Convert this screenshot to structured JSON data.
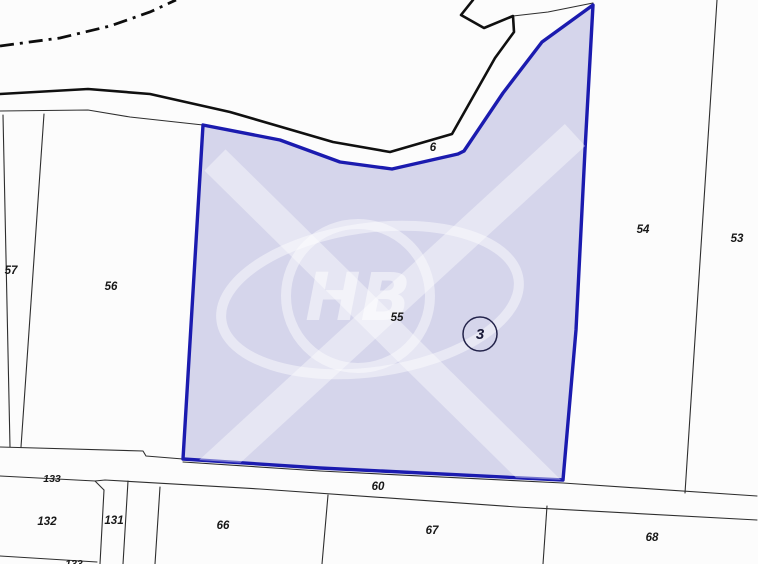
{
  "map": {
    "background_color": "#fcfcfc",
    "selected_parcel": {
      "number": "55",
      "fill": "#d5d5eb",
      "stroke": "#1b1baf",
      "points": "203,125 280,140 340,162 392,169 458,154 464,151 503,93 542,42 593,5 585,150 576,330 563,480 320,468 183,459"
    },
    "marker": {
      "number": "3",
      "cx": "480",
      "cy": "334",
      "r": "17",
      "text_y": "339"
    },
    "watermark": {
      "text": "НВ"
    },
    "lines": {
      "municipal_boundary": {
        "points": "0,46 60,38 110,26 150,12 176,0"
      },
      "road_upper_thick": {
        "points": "0,94 88,89 150,94 230,112 333,142 390,152 452,134 495,58 514,32 513,16 484,28 461,15 473,0"
      },
      "road_upper_thin_right": {
        "points": "513,16 548,12 593,3"
      },
      "road_upper_thin_left": {
        "points": "0,111 88,110 130,117 203,125"
      },
      "parcel57_left": {
        "points": "3,115 10,447"
      },
      "parcel57_56": {
        "points": "44,114 21,447"
      },
      "parcel53_54": {
        "points": "717,0 685,493"
      },
      "road_lower_top_left": {
        "points": "0,447 143,451 146,456 183,459"
      },
      "road_lower_top_right": {
        "points": "183,462 320,471 563,483 757,496"
      },
      "road_lower_bottom": {
        "points": "0,476 95,481 105,480 260,489 517,507 757,520"
      },
      "notch_131": {
        "points": "95,481 104,490"
      },
      "parcel131_left": {
        "points": "104,490 100,564"
      },
      "parcel131_right": {
        "points": "128,481 123,564"
      },
      "parcel66_left": {
        "points": "160,487 155,564"
      },
      "parcel66_67": {
        "points": "328,495 322,564"
      },
      "parcel67_68": {
        "points": "547,506 543,564"
      },
      "parcel132_bottom": {
        "points": "0,556 97,562"
      }
    },
    "labels": [
      {
        "text": "57",
        "x": "11",
        "y": "274"
      },
      {
        "text": "56",
        "x": "111",
        "y": "290"
      },
      {
        "text": "6",
        "x": "433",
        "y": "151"
      },
      {
        "text": "54",
        "x": "643",
        "y": "233"
      },
      {
        "text": "53",
        "x": "737",
        "y": "242"
      },
      {
        "text": "55",
        "x": "397",
        "y": "321"
      },
      {
        "text": "60",
        "x": "378",
        "y": "490"
      },
      {
        "text": "133",
        "x": "52",
        "y": "482"
      },
      {
        "text": "132",
        "x": "47",
        "y": "525"
      },
      {
        "text": "131",
        "x": "114",
        "y": "524"
      },
      {
        "text": "66",
        "x": "223",
        "y": "529"
      },
      {
        "text": "67",
        "x": "432",
        "y": "534"
      },
      {
        "text": "68",
        "x": "652",
        "y": "541"
      },
      {
        "text": "133",
        "x": "74",
        "y": "567"
      }
    ]
  }
}
